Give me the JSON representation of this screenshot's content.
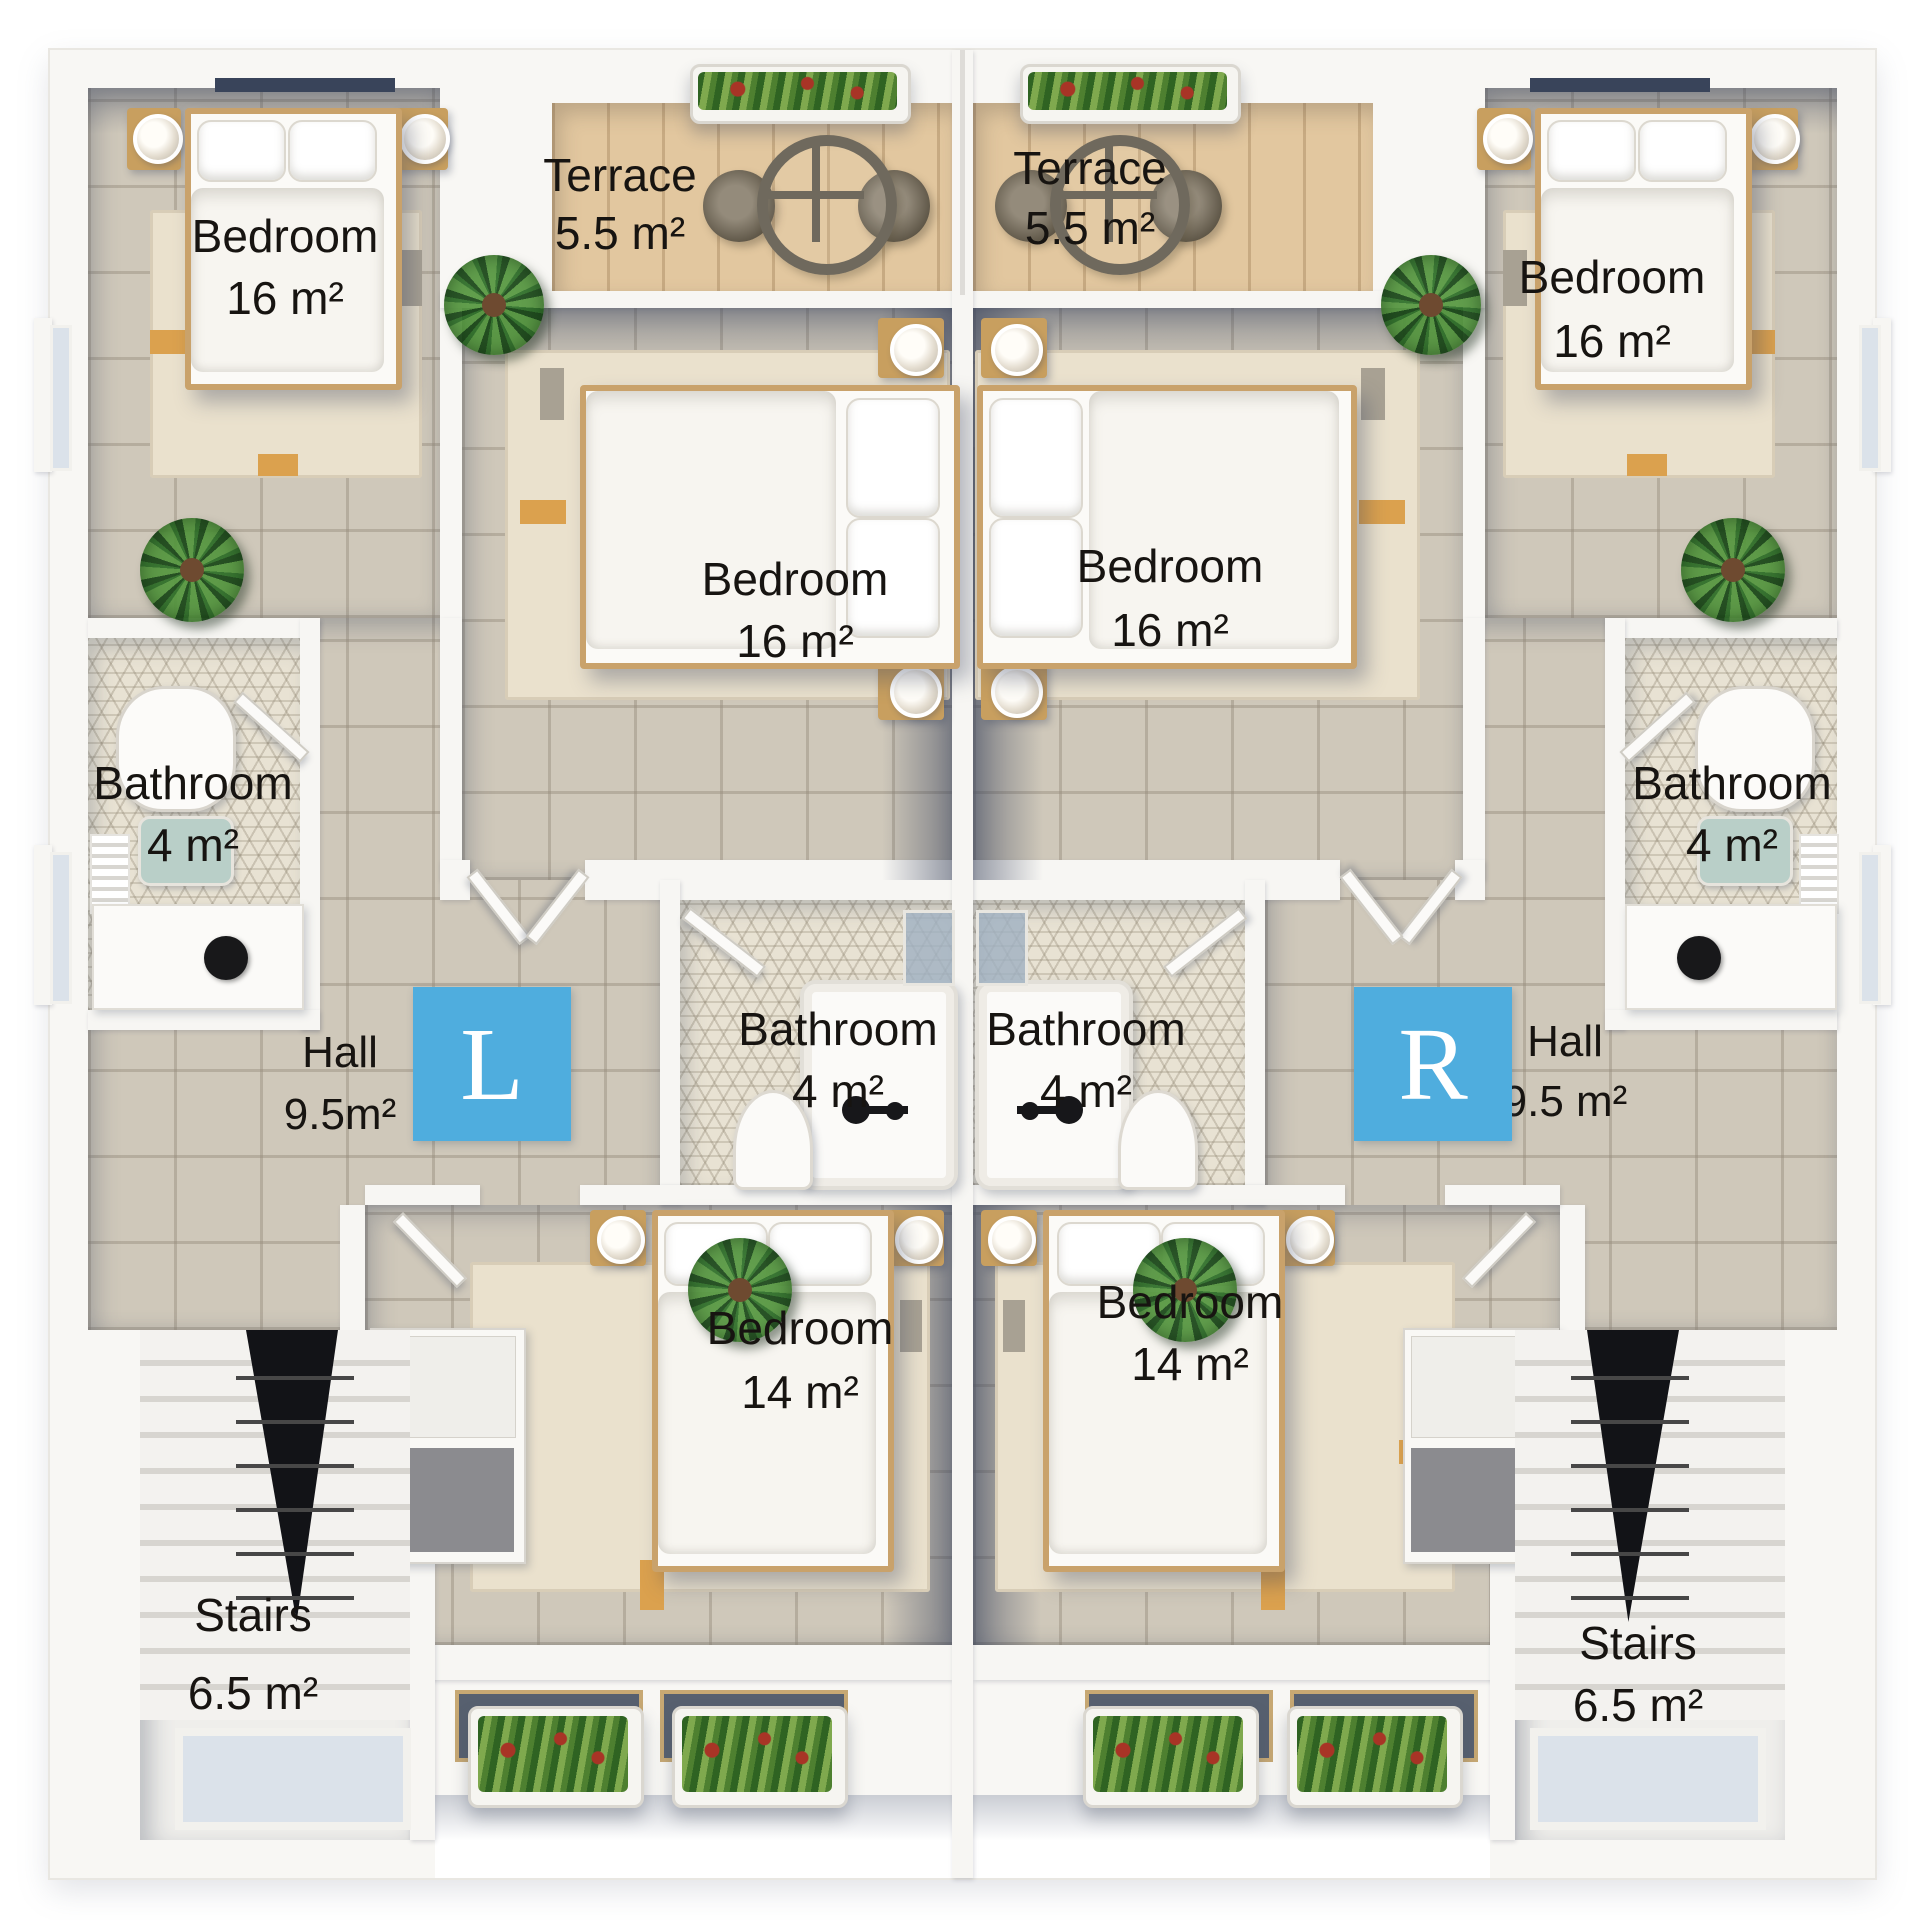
{
  "floorplan": {
    "colors": {
      "badge_blue": "#4fadde",
      "label_text": "#171411",
      "terrace_wood": "#e2c79f",
      "floor_tile": "#cfc8ba",
      "bathroom_mosaic": "#e8e2d3"
    },
    "units": [
      {
        "id": "left",
        "badge": "L",
        "rooms": [
          {
            "key": "bedroom_top",
            "name": "Bedroom",
            "area": "16 m²"
          },
          {
            "key": "terrace",
            "name": "Terrace",
            "area": "5.5 m²"
          },
          {
            "key": "bedroom_middle",
            "name": "Bedroom",
            "area": "16 m²"
          },
          {
            "key": "bathroom_side",
            "name": "Bathroom",
            "area": "4 m²"
          },
          {
            "key": "hall",
            "name": "Hall",
            "area": "9.5m²"
          },
          {
            "key": "bathroom_center",
            "name": "Bathroom",
            "area": "4 m²"
          },
          {
            "key": "bedroom_bottom",
            "name": "Bedroom",
            "area": "14 m²"
          },
          {
            "key": "stairs",
            "name": "Stairs",
            "area": "6.5 m²"
          }
        ]
      },
      {
        "id": "right",
        "badge": "R",
        "rooms": [
          {
            "key": "bedroom_top",
            "name": "Bedroom",
            "area": "16 m²"
          },
          {
            "key": "terrace",
            "name": "Terrace",
            "area": "5.5 m²"
          },
          {
            "key": "bedroom_middle",
            "name": "Bedroom",
            "area": "16 m²"
          },
          {
            "key": "bathroom_side",
            "name": "Bathroom",
            "area": "4 m²"
          },
          {
            "key": "hall",
            "name": "Hall",
            "area": "9.5 m²"
          },
          {
            "key": "bathroom_center",
            "name": "Bathroom",
            "area": "4 m²"
          },
          {
            "key": "bedroom_bottom",
            "name": "Bedroom",
            "area": "14 m²"
          },
          {
            "key": "stairs",
            "name": "Stairs",
            "area": "6.5 m²"
          }
        ]
      }
    ]
  }
}
